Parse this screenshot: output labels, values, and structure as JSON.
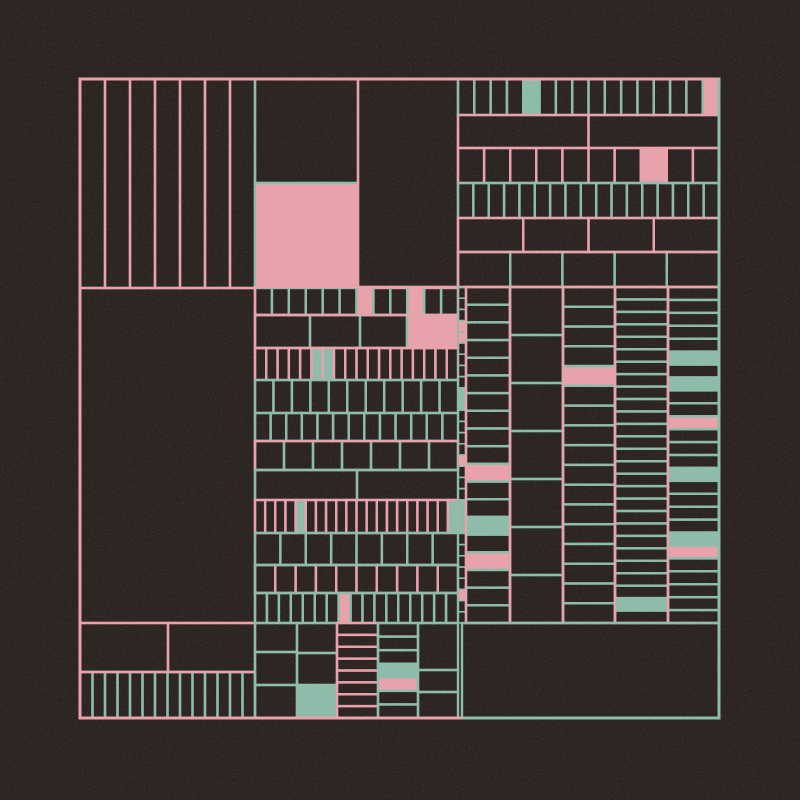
{
  "artwork": {
    "title": "generative-subdivision-grid",
    "canvas": {
      "width": 800,
      "height": 800,
      "background": "#2b2421"
    },
    "palette": {
      "pink": "#e9a2ab",
      "teal": "#8dbcab",
      "dark": "#2b2421",
      "noise_speckle": "#c27f63"
    },
    "line_width": 2.4,
    "frame": {
      "x": 80,
      "y": 79,
      "w": 639,
      "h": 639,
      "stroke": "pink",
      "lw": 3,
      "accent": {
        "color": "teal",
        "lw": 3,
        "points": [
          [
            719,
            79
          ],
          [
            719,
            718
          ],
          [
            462,
            718
          ]
        ]
      }
    },
    "groups": [
      {
        "name": "top-left-stripes",
        "x": 80,
        "y": 79,
        "w": 175,
        "h": 209,
        "dir": "v",
        "n": 7,
        "stroke": "pink"
      },
      {
        "name": "top-mid-left-stack",
        "x": 255,
        "y": 79,
        "w": 103,
        "h": 209,
        "dir": "h",
        "bounds": [
          79,
          183,
          288
        ],
        "stroke": "teal",
        "fills": {
          "1": "pink"
        }
      },
      {
        "name": "top-mid-right-cell",
        "x": 358,
        "y": 79,
        "w": 100,
        "h": 209,
        "type": "leaf",
        "stroke": "pink"
      },
      {
        "name": "top-right-row-1",
        "x": 458,
        "y": 79,
        "w": 261,
        "h": 36,
        "dir": "v",
        "n": 16,
        "stroke": "teal",
        "fills": {
          "4": "teal",
          "15": "pink"
        }
      },
      {
        "name": "top-right-row-2",
        "x": 458,
        "y": 115,
        "w": 261,
        "h": 33,
        "dir": "v",
        "n": 2,
        "stroke": "pink"
      },
      {
        "name": "top-right-row-3",
        "x": 458,
        "y": 148,
        "w": 261,
        "h": 35,
        "dir": "v",
        "n": 10,
        "stroke": "pink",
        "fills": {
          "7": "pink"
        }
      },
      {
        "name": "top-right-row-4",
        "x": 458,
        "y": 183,
        "w": 261,
        "h": 35,
        "dir": "v",
        "n": 17,
        "stroke": "teal"
      },
      {
        "name": "top-right-row-5",
        "x": 458,
        "y": 218,
        "w": 261,
        "h": 34,
        "dir": "v",
        "n": 4,
        "stroke": "pink"
      },
      {
        "name": "top-right-row-6",
        "x": 458,
        "y": 252,
        "w": 261,
        "h": 35,
        "dir": "v",
        "n": 5,
        "stroke": "teal",
        "frame": "pink"
      },
      {
        "name": "left-large-cell",
        "x": 80,
        "y": 288,
        "w": 175,
        "h": 335,
        "type": "leaf",
        "stroke": "pink"
      },
      {
        "name": "mid-row-1",
        "x": 255,
        "y": 287,
        "w": 203,
        "h": 28,
        "dir": "v",
        "n": 12,
        "stroke": "teal",
        "frame": "pink",
        "fills": {
          "6": "pink",
          "9": "pink"
        }
      },
      {
        "name": "mid-row-2",
        "x": 255,
        "y": 315,
        "w": 203,
        "h": 33,
        "dir": "v",
        "bounds": [
          255,
          310,
          360,
          407,
          458
        ],
        "stroke": "teal",
        "frame": "pink",
        "fills": {
          "3": "pink"
        }
      },
      {
        "name": "mid-row-3",
        "x": 255,
        "y": 348,
        "w": 203,
        "h": 32,
        "dir": "v",
        "n": 18,
        "stroke": "pink",
        "fills": {
          "5": "teal",
          "6": "teal"
        }
      },
      {
        "name": "mid-row-4",
        "x": 255,
        "y": 380,
        "w": 203,
        "h": 33,
        "dir": "v",
        "n": 11,
        "stroke": "teal"
      },
      {
        "name": "mid-row-5",
        "x": 255,
        "y": 413,
        "w": 203,
        "h": 28,
        "dir": "v",
        "n": 13,
        "stroke": "teal"
      },
      {
        "name": "mid-row-6",
        "x": 255,
        "y": 441,
        "w": 203,
        "h": 29,
        "dir": "v",
        "n": 7,
        "stroke": "teal",
        "frame": "pink"
      },
      {
        "name": "mid-row-7",
        "x": 255,
        "y": 470,
        "w": 203,
        "h": 30,
        "dir": "v",
        "bounds": [
          255,
          357,
          458
        ],
        "stroke": "teal"
      },
      {
        "name": "mid-row-8",
        "x": 255,
        "y": 500,
        "w": 203,
        "h": 33,
        "dir": "v",
        "n": 20,
        "stroke": "pink",
        "fills": {
          "4": "teal",
          "19": "teal"
        }
      },
      {
        "name": "mid-row-9",
        "x": 255,
        "y": 533,
        "w": 203,
        "h": 32,
        "dir": "v",
        "n": 8,
        "stroke": "teal"
      },
      {
        "name": "mid-row-10",
        "x": 255,
        "y": 565,
        "w": 203,
        "h": 28,
        "dir": "v",
        "n": 10,
        "stroke": "pink",
        "frame": "teal"
      },
      {
        "name": "mid-row-11",
        "x": 255,
        "y": 593,
        "w": 203,
        "h": 30,
        "dir": "v",
        "n": 17,
        "stroke": "teal",
        "fills": {
          "7": "pink"
        }
      },
      {
        "name": "ticker-strip",
        "x": 458,
        "y": 287,
        "w": 8,
        "h": 336,
        "dir": "h",
        "n": 30,
        "stroke": "teal",
        "lw": 1.5,
        "fills": {
          "3": "pink",
          "4": "pink",
          "9": "teal",
          "10": "teal",
          "15": "pink",
          "19": "teal",
          "20": "teal",
          "21": "teal",
          "27": "pink"
        }
      },
      {
        "name": "right-col-a",
        "x": 466,
        "y": 287,
        "w": 44,
        "h": 336,
        "dir": "h",
        "n": 19,
        "stroke": "teal",
        "frame": "pink",
        "fills": {
          "10": "pink",
          "13": "teal",
          "15": "pink"
        }
      },
      {
        "name": "right-col-b",
        "x": 510,
        "y": 287,
        "w": 53,
        "h": 336,
        "dir": "h",
        "n": 7,
        "stroke": "teal",
        "frame": "pink"
      },
      {
        "name": "right-col-c",
        "x": 563,
        "y": 287,
        "w": 52,
        "h": 336,
        "dir": "h",
        "n": 17,
        "stroke": "teal",
        "frame": "pink",
        "fills": {
          "4": "pink"
        }
      },
      {
        "name": "right-col-d",
        "x": 615,
        "y": 287,
        "w": 53,
        "h": 336,
        "dir": "h",
        "n": 27,
        "stroke": "teal",
        "frame": "pink",
        "fills": {
          "25": "teal"
        }
      },
      {
        "name": "right-col-e",
        "x": 668,
        "y": 287,
        "w": 51,
        "h": 336,
        "dir": "h",
        "n": 26,
        "stroke": "teal",
        "frame": "pink",
        "fills": {
          "5": "teal",
          "7": "teal",
          "10": "pink",
          "14": "teal",
          "19": "teal",
          "20": "pink"
        }
      },
      {
        "name": "bottom-left-row-1",
        "x": 80,
        "y": 623,
        "w": 175,
        "h": 49,
        "dir": "v",
        "bounds": [
          80,
          168,
          255
        ],
        "stroke": "pink"
      },
      {
        "name": "bottom-left-row-2",
        "x": 80,
        "y": 672,
        "w": 175,
        "h": 46,
        "dir": "v",
        "n": 14,
        "stroke": "teal",
        "frame": "pink"
      },
      {
        "name": "bottom-mid-col-1",
        "x": 255,
        "y": 623,
        "w": 42,
        "h": 95,
        "dir": "h",
        "bounds": [
          623,
          652,
          685,
          718
        ],
        "stroke": "teal"
      },
      {
        "name": "bottom-mid-col-2",
        "x": 297,
        "y": 623,
        "w": 40,
        "h": 95,
        "dir": "h",
        "bounds": [
          623,
          653,
          685,
          718
        ],
        "stroke": "teal",
        "fills": {
          "2": "teal"
        }
      },
      {
        "name": "bottom-mid-col-3",
        "x": 337,
        "y": 623,
        "w": 41,
        "h": 95,
        "dir": "h",
        "n": 8,
        "stroke": "pink"
      },
      {
        "name": "bottom-mid-col-4",
        "x": 378,
        "y": 623,
        "w": 40,
        "h": 95,
        "dir": "h",
        "n": 7,
        "stroke": "teal",
        "fills": {
          "3": "teal",
          "4": "pink"
        }
      },
      {
        "name": "bottom-mid-col-5",
        "x": 418,
        "y": 623,
        "w": 40,
        "h": 95,
        "dir": "h",
        "bounds": [
          623,
          670,
          692,
          718
        ],
        "stroke": "teal"
      },
      {
        "name": "bottom-right-cell",
        "x": 462,
        "y": 623,
        "w": 257,
        "h": 95,
        "type": "leaf",
        "stroke": "teal"
      }
    ]
  }
}
